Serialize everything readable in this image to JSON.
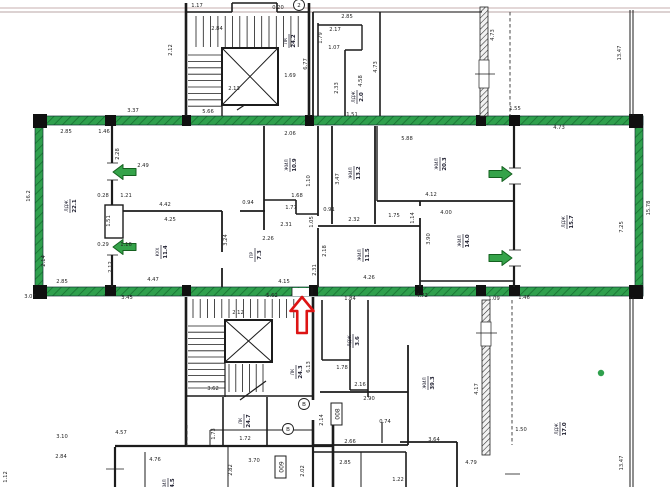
{
  "meta": {
    "type": "architectural-floor-plan",
    "description": "scanned apartment floor plan; middle apartment outlined with green marker, loggia doors marked with green arrows, entrance marked with red arrow"
  },
  "palette": {
    "wall": "#1c1c1c",
    "green": "#2fa04d",
    "green_dark": "#176f31",
    "arrow_green": "#35a34a",
    "arrow_green_edge": "#1b7а2f",
    "red": "#dd1414",
    "dim_text": "#252525",
    "page_line1": "#d2bfbf",
    "page_line2": "#c7b7b7",
    "white": "#ffffff"
  },
  "page_lines": [
    {
      "y": 8
    },
    {
      "y": 12
    }
  ],
  "green_outline": [
    [
      35,
      116,
      608,
      9
    ],
    [
      35,
      287,
      608,
      9
    ],
    [
      35,
      116,
      8,
      180
    ],
    [
      635,
      116,
      8,
      180
    ]
  ],
  "corner_blocks": [
    [
      33,
      114,
      14,
      14
    ],
    [
      33,
      285,
      14,
      14
    ],
    [
      105,
      115,
      11,
      11
    ],
    [
      105,
      285,
      11,
      11
    ],
    [
      182,
      115,
      9,
      11
    ],
    [
      305,
      115,
      9,
      11
    ],
    [
      182,
      285,
      9,
      11
    ],
    [
      309,
      285,
      9,
      11
    ],
    [
      476,
      115,
      10,
      11
    ],
    [
      509,
      115,
      11,
      11
    ],
    [
      509,
      285,
      11,
      11
    ],
    [
      629,
      114,
      14,
      14
    ],
    [
      629,
      285,
      14,
      14
    ],
    [
      415,
      285,
      8,
      10
    ],
    [
      476,
      285,
      10,
      11
    ]
  ],
  "walls": [
    [
      186,
      3,
      186,
      116,
      2.6
    ],
    [
      309,
      3,
      309,
      116,
      2.6
    ],
    [
      186,
      12,
      232,
      12,
      1.6
    ],
    [
      232,
      3,
      232,
      12,
      1.6
    ],
    [
      232,
      3,
      277,
      3,
      1.6
    ],
    [
      277,
      3,
      277,
      12,
      1.6
    ],
    [
      277,
      12,
      309,
      12,
      1.6
    ],
    [
      222,
      48,
      222,
      116,
      1.4
    ],
    [
      237,
      110,
      266,
      91,
      1.2
    ],
    [
      313,
      12,
      313,
      116,
      1.8
    ],
    [
      313,
      12,
      482,
      12,
      1
    ],
    [
      318,
      23,
      318,
      116,
      1.6
    ],
    [
      318,
      25,
      362,
      25,
      1.4
    ],
    [
      362,
      25,
      362,
      50,
      1.4
    ],
    [
      345,
      50,
      362,
      50,
      1.4
    ],
    [
      345,
      50,
      345,
      116,
      1.6
    ],
    [
      380,
      12,
      380,
      116,
      1.6
    ],
    [
      630,
      10,
      630,
      116,
      1
    ],
    [
      633,
      10,
      633,
      116,
      1
    ],
    [
      112,
      126,
      112,
      163,
      2.2
    ],
    [
      112,
      180,
      112,
      205,
      2.2
    ],
    [
      112,
      255,
      112,
      287,
      2.2
    ],
    [
      122,
      211,
      222,
      211,
      1.8
    ],
    [
      240,
      211,
      265,
      211,
      1.8
    ],
    [
      222,
      211,
      222,
      252,
      1.8
    ],
    [
      222,
      268,
      222,
      287,
      1.8
    ],
    [
      264,
      126,
      264,
      230,
      1.8
    ],
    [
      264,
      200,
      296,
      200,
      1.6
    ],
    [
      296,
      200,
      296,
      214,
      1.6
    ],
    [
      296,
      214,
      318,
      214,
      1.6
    ],
    [
      318,
      126,
      318,
      216,
      1.8
    ],
    [
      318,
      228,
      318,
      287,
      1.8
    ],
    [
      332,
      126,
      332,
      224,
      1.8
    ],
    [
      375,
      126,
      375,
      224,
      1.8
    ],
    [
      377,
      126,
      377,
      201,
      1.4
    ],
    [
      318,
      226,
      420,
      226,
      1.8
    ],
    [
      377,
      201,
      513,
      201,
      1.8
    ],
    [
      420,
      201,
      420,
      206,
      1.8
    ],
    [
      420,
      218,
      420,
      287,
      1.8
    ],
    [
      420,
      281,
      513,
      281,
      1.6
    ],
    [
      514,
      126,
      514,
      168,
      2.2
    ],
    [
      514,
      184,
      514,
      250,
      2.2
    ],
    [
      514,
      266,
      514,
      287,
      2.2
    ],
    [
      186,
      297,
      186,
      447,
      2.6
    ],
    [
      313,
      297,
      313,
      400,
      2.6
    ],
    [
      313,
      420,
      313,
      447,
      2.6
    ],
    [
      225,
      320,
      225,
      397,
      1.2
    ],
    [
      186,
      396,
      313,
      396,
      1.6
    ],
    [
      223,
      397,
      223,
      445,
      1.6
    ],
    [
      267,
      397,
      267,
      445,
      1.6
    ],
    [
      115,
      446,
      333,
      446,
      2.2
    ],
    [
      240,
      400,
      266,
      381,
      1.2
    ],
    [
      210,
      430,
      313,
      430,
      1
    ],
    [
      210,
      430,
      210,
      446,
      1
    ],
    [
      322,
      300,
      322,
      360,
      1.6
    ],
    [
      350,
      300,
      350,
      390,
      1.6
    ],
    [
      368,
      300,
      368,
      397,
      1.6
    ],
    [
      322,
      360,
      350,
      360,
      1.6
    ],
    [
      350,
      390,
      368,
      390,
      1.6
    ],
    [
      320,
      392,
      408,
      392,
      1.8
    ],
    [
      408,
      345,
      408,
      445,
      1.8
    ],
    [
      382,
      422,
      382,
      443,
      1.2
    ],
    [
      313,
      445,
      408,
      445,
      1.8
    ],
    [
      313,
      452,
      406,
      452,
      1.6
    ],
    [
      313,
      447,
      313,
      487,
      2.2
    ],
    [
      406,
      452,
      406,
      487,
      1.6
    ],
    [
      361,
      452,
      361,
      487,
      1
    ],
    [
      400,
      442,
      457,
      442,
      1.8
    ],
    [
      457,
      442,
      457,
      487,
      1.8
    ],
    [
      630,
      297,
      630,
      487,
      1
    ],
    [
      633,
      297,
      633,
      487,
      1
    ],
    [
      115,
      447,
      115,
      487,
      2.2
    ],
    [
      145,
      452,
      145,
      487,
      1
    ],
    [
      228,
      447,
      228,
      487,
      1
    ],
    [
      333,
      425,
      333,
      487,
      2.6
    ]
  ],
  "tread_groups": [
    {
      "o": "v",
      "a1": 196,
      "a2": 304,
      "step": 7.3,
      "b1": 16,
      "b2": 47
    },
    {
      "o": "h",
      "a1": 55,
      "a2": 112,
      "step": 6.4,
      "b1": 188,
      "b2": 222
    },
    {
      "o": "v",
      "a1": 193,
      "a2": 307,
      "step": 7.2,
      "b1": 299,
      "b2": 318
    },
    {
      "o": "h",
      "a1": 326,
      "a2": 393,
      "step": 6.2,
      "b1": 188,
      "b2": 225
    },
    {
      "o": "v",
      "a1": 229,
      "a2": 269,
      "step": 6.8,
      "b1": 364,
      "b2": 392
    }
  ],
  "elevators": [
    [
      222,
      48,
      56,
      57
    ],
    [
      225,
      320,
      47,
      42
    ]
  ],
  "duct_boxes": [
    [
      105,
      205,
      18,
      33
    ]
  ],
  "hatch_walls": [
    [
      480,
      7,
      8,
      109
    ],
    [
      482,
      300,
      8,
      155
    ]
  ],
  "window_gaps": [
    [
      479,
      60,
      10,
      28
    ],
    [
      481,
      322,
      10,
      24
    ]
  ],
  "door_gaps": [
    [
      292,
      288,
      20,
      8
    ]
  ],
  "dashed_lines": [
    [
      510,
      12,
      510,
      116
    ],
    [
      187,
      425,
      187,
      447
    ],
    [
      512,
      300,
      512,
      445
    ]
  ],
  "ticks": [
    [
      475,
      74,
      495,
      74
    ],
    [
      476,
      333,
      497,
      333
    ],
    [
      505,
      474,
      520,
      474
    ],
    [
      106,
      469,
      124,
      469
    ],
    [
      292,
      287,
      292,
      296
    ],
    [
      312,
      287,
      312,
      296
    ],
    [
      107,
      163,
      118,
      163
    ],
    [
      107,
      180,
      118,
      180
    ],
    [
      107,
      238,
      118,
      238
    ],
    [
      107,
      255,
      118,
      255
    ],
    [
      509,
      168,
      521,
      168
    ],
    [
      509,
      184,
      521,
      184
    ],
    [
      509,
      250,
      521,
      250
    ],
    [
      509,
      266,
      521,
      266
    ]
  ],
  "green_arrows": [
    {
      "x": 113,
      "y": 172,
      "dir": "left"
    },
    {
      "x": 113,
      "y": 247,
      "dir": "left"
    },
    {
      "x": 512,
      "y": 174,
      "dir": "right"
    },
    {
      "x": 512,
      "y": 258,
      "dir": "right"
    }
  ],
  "red_arrow": {
    "x": 302,
    "y": 297,
    "dir": "up"
  },
  "dims": [
    [
      "1.17",
      197,
      7,
      0
    ],
    [
      "2.84",
      217,
      30,
      0
    ],
    [
      "0.20",
      278,
      9,
      0
    ],
    [
      "2.13",
      234,
      90,
      0
    ],
    [
      "1.69",
      290,
      77,
      0
    ],
    [
      "5.66",
      208,
      113,
      0
    ],
    [
      "3.37",
      133,
      112,
      0
    ],
    [
      "2.12",
      172,
      50,
      1
    ],
    [
      "2.85",
      347,
      18,
      0
    ],
    [
      "2.17",
      335,
      31,
      0
    ],
    [
      "1.79",
      322,
      38,
      1
    ],
    [
      "1.07",
      334,
      49,
      0
    ],
    [
      "6.77",
      307,
      64,
      1
    ],
    [
      "4.73",
      377,
      67,
      1
    ],
    [
      "4.58",
      362,
      81,
      1
    ],
    [
      "2.33",
      338,
      88,
      1
    ],
    [
      "1.51",
      352,
      116,
      0
    ],
    [
      "4.73",
      494,
      35,
      1
    ],
    [
      "1.55",
      515,
      110,
      0
    ],
    [
      "13.47",
      621,
      53,
      1
    ],
    [
      "2.85",
      66,
      133,
      0
    ],
    [
      "1.46",
      104,
      133,
      0
    ],
    [
      "2.49",
      143,
      167,
      0
    ],
    [
      "2.28",
      119,
      154,
      1
    ],
    [
      "0.28",
      103,
      197,
      0
    ],
    [
      "1.21",
      126,
      197,
      0
    ],
    [
      "1.51",
      110,
      221,
      1
    ],
    [
      "0.29",
      103,
      246,
      0
    ],
    [
      "1.16",
      126,
      246,
      0
    ],
    [
      "2.12",
      112,
      267,
      1
    ],
    [
      "2.85",
      62,
      283,
      0
    ],
    [
      "2.14",
      45,
      261,
      1
    ],
    [
      "16.2",
      30,
      196,
      1
    ],
    [
      "4.42",
      165,
      206,
      0
    ],
    [
      "4.25",
      170,
      221,
      0
    ],
    [
      "4.47",
      153,
      281,
      0
    ],
    [
      "3.24",
      227,
      240,
      1
    ],
    [
      "0.94",
      248,
      204,
      0
    ],
    [
      "2.06",
      290,
      135,
      0
    ],
    [
      "1.68",
      297,
      197,
      0
    ],
    [
      "1.77",
      291,
      209,
      0
    ],
    [
      "1.10",
      310,
      181,
      1
    ],
    [
      "3.47",
      339,
      179,
      1
    ],
    [
      "2.32",
      354,
      221,
      0
    ],
    [
      "0.91",
      329,
      211,
      0
    ],
    [
      "1.05",
      313,
      222,
      1
    ],
    [
      "2.31",
      286,
      226,
      0
    ],
    [
      "2.26",
      268,
      240,
      0
    ],
    [
      "4.15",
      284,
      283,
      0
    ],
    [
      "2.31",
      316,
      270,
      1
    ],
    [
      "2.18",
      326,
      251,
      1
    ],
    [
      "4.26",
      369,
      279,
      0
    ],
    [
      "5.88",
      407,
      140,
      0
    ],
    [
      "4.12",
      431,
      196,
      0
    ],
    [
      "1.75",
      394,
      217,
      0
    ],
    [
      "1.14",
      414,
      218,
      1
    ],
    [
      "4.00",
      446,
      214,
      0
    ],
    [
      "3.90",
      430,
      239,
      1
    ],
    [
      "4.73",
      559,
      129,
      0
    ],
    [
      "7.25",
      623,
      227,
      1
    ],
    [
      "15.78",
      650,
      208,
      1
    ],
    [
      "5.62",
      272,
      297,
      0
    ],
    [
      "1.84",
      350,
      300,
      0
    ],
    [
      "3.07",
      30,
      298,
      0
    ],
    [
      "3.45",
      127,
      299,
      0
    ],
    [
      "4.72",
      422,
      297,
      0
    ],
    [
      "1.09",
      494,
      300,
      0
    ],
    [
      "1.46",
      524,
      299,
      0
    ],
    [
      "2.12",
      238,
      314,
      0
    ],
    [
      "3.62",
      213,
      390,
      0
    ],
    [
      "1.72",
      245,
      440,
      0
    ],
    [
      "6.13",
      310,
      367,
      1
    ],
    [
      "2.14",
      323,
      420,
      1
    ],
    [
      "1.78",
      342,
      369,
      0
    ],
    [
      "2.16",
      360,
      386,
      0
    ],
    [
      "2.90",
      369,
      400,
      0
    ],
    [
      "2.66",
      350,
      443,
      0
    ],
    [
      "2.85",
      345,
      464,
      0
    ],
    [
      "0.74",
      385,
      423,
      0
    ],
    [
      "1.22",
      398,
      481,
      0
    ],
    [
      "2.02",
      304,
      471,
      1
    ],
    [
      "4.17",
      478,
      389,
      1
    ],
    [
      "1.50",
      521,
      431,
      0
    ],
    [
      "3.64",
      434,
      441,
      0
    ],
    [
      "4.79",
      471,
      464,
      0
    ],
    [
      "13.47",
      623,
      463,
      1
    ],
    [
      "3.10",
      62,
      438,
      0
    ],
    [
      "4.57",
      121,
      434,
      0
    ],
    [
      "2.84",
      61,
      458,
      0
    ],
    [
      "4.76",
      155,
      461,
      0
    ],
    [
      "1.73",
      215,
      434,
      1
    ],
    [
      "3.70",
      254,
      462,
      0
    ],
    [
      "2.82",
      232,
      470,
      1
    ],
    [
      "1.12",
      7,
      477,
      1
    ]
  ],
  "room_labels": [
    [
      "ЛДЖ",
      "22.1",
      70,
      206
    ],
    [
      "КУХ",
      "11.4",
      161,
      252
    ],
    [
      "ЖИЛ",
      "10.9",
      290,
      165
    ],
    [
      "ЖИЛ",
      "13.2",
      354,
      173
    ],
    [
      "ЖИЛ",
      "20.3",
      440,
      164
    ],
    [
      "ЖИЛ",
      "14.0",
      463,
      241
    ],
    [
      "ЖИЛ",
      "11.5",
      363,
      255
    ],
    [
      "ПР",
      "7.3",
      255,
      255
    ],
    [
      "ЛДЖ",
      "15.7",
      567,
      222
    ],
    [
      "ЛК",
      "24.2",
      289,
      41
    ],
    [
      "ЛДЖ",
      "2.0",
      357,
      97
    ],
    [
      "ЛК",
      "24.3",
      296,
      372
    ],
    [
      "ЛДЖ",
      "3.6",
      353,
      341
    ],
    [
      "ЖИЛ",
      "39.3",
      428,
      383
    ],
    [
      "ЛДЖ",
      "17.0",
      560,
      429
    ],
    [
      "ЛК",
      "24.7",
      244,
      421
    ],
    [
      "ЖИЛ",
      "24.5",
      168,
      485
    ]
  ],
  "boxed_labels": [
    [
      "008",
      337,
      414
    ],
    [
      "009",
      281,
      467
    ]
  ],
  "circled_labels": [
    [
      "2",
      299,
      5
    ],
    [
      "В",
      304,
      404
    ],
    [
      "В",
      288,
      429
    ]
  ],
  "dots": [
    [
      601,
      373
    ]
  ]
}
